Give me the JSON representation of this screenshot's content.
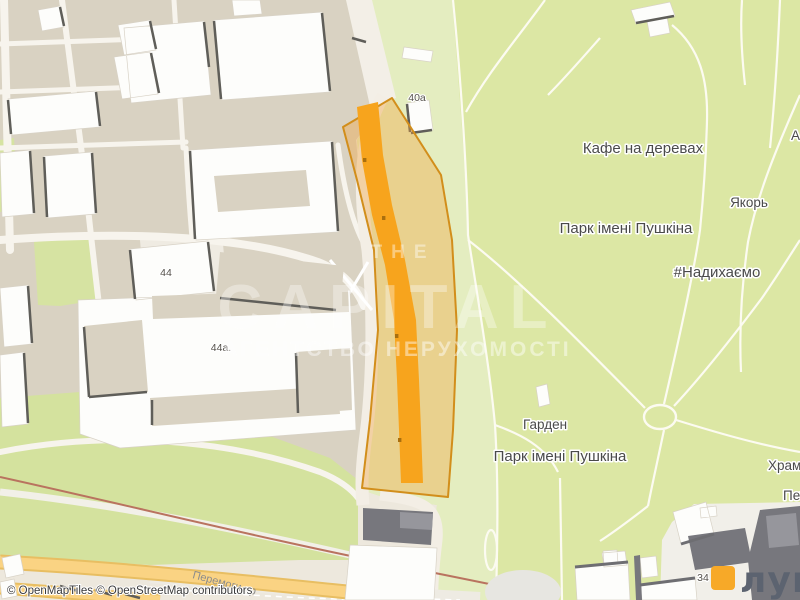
{
  "map": {
    "attribution": "© OpenMapTiles © OpenStreetMap contributors",
    "labels": {
      "cafe": "Кафе на деревах",
      "park_name_north": "Парк імені Пушкіна",
      "park_name_south": "Парк імені Пушкіна",
      "yakir": "Якорь",
      "hashtag": "#Надихаємо",
      "garden": "Гарден",
      "khram_cut": "Храм п",
      "pet_cut": "Пет",
      "a_cut": "А",
      "house_40a": "40а",
      "house_44": "44",
      "house_44a": "44а.",
      "house_34": "34",
      "street_peremohy": "Перемоги пр"
    },
    "watermark": {
      "line1": "THE",
      "line2": "CAPITAL",
      "line3": "АГЕНТСТВО НЕРУХОМОСТІ"
    },
    "logo": {
      "text": "лун",
      "square_color": "#F7A928",
      "text_color": "#5C6370"
    },
    "colors": {
      "park_green": "#DCE7A4",
      "park_green_pale": "#E4EDC0",
      "urban_block": "#D9D2C2",
      "base": "#EDE8DD",
      "parcel_fill": "#F2A33C",
      "parcel_stroke": "#D28E1B",
      "parcel_building": "#F7A41D",
      "yellow_road": "#FAD383",
      "railway": "#B9735F",
      "gray_building": "#77777D"
    }
  }
}
